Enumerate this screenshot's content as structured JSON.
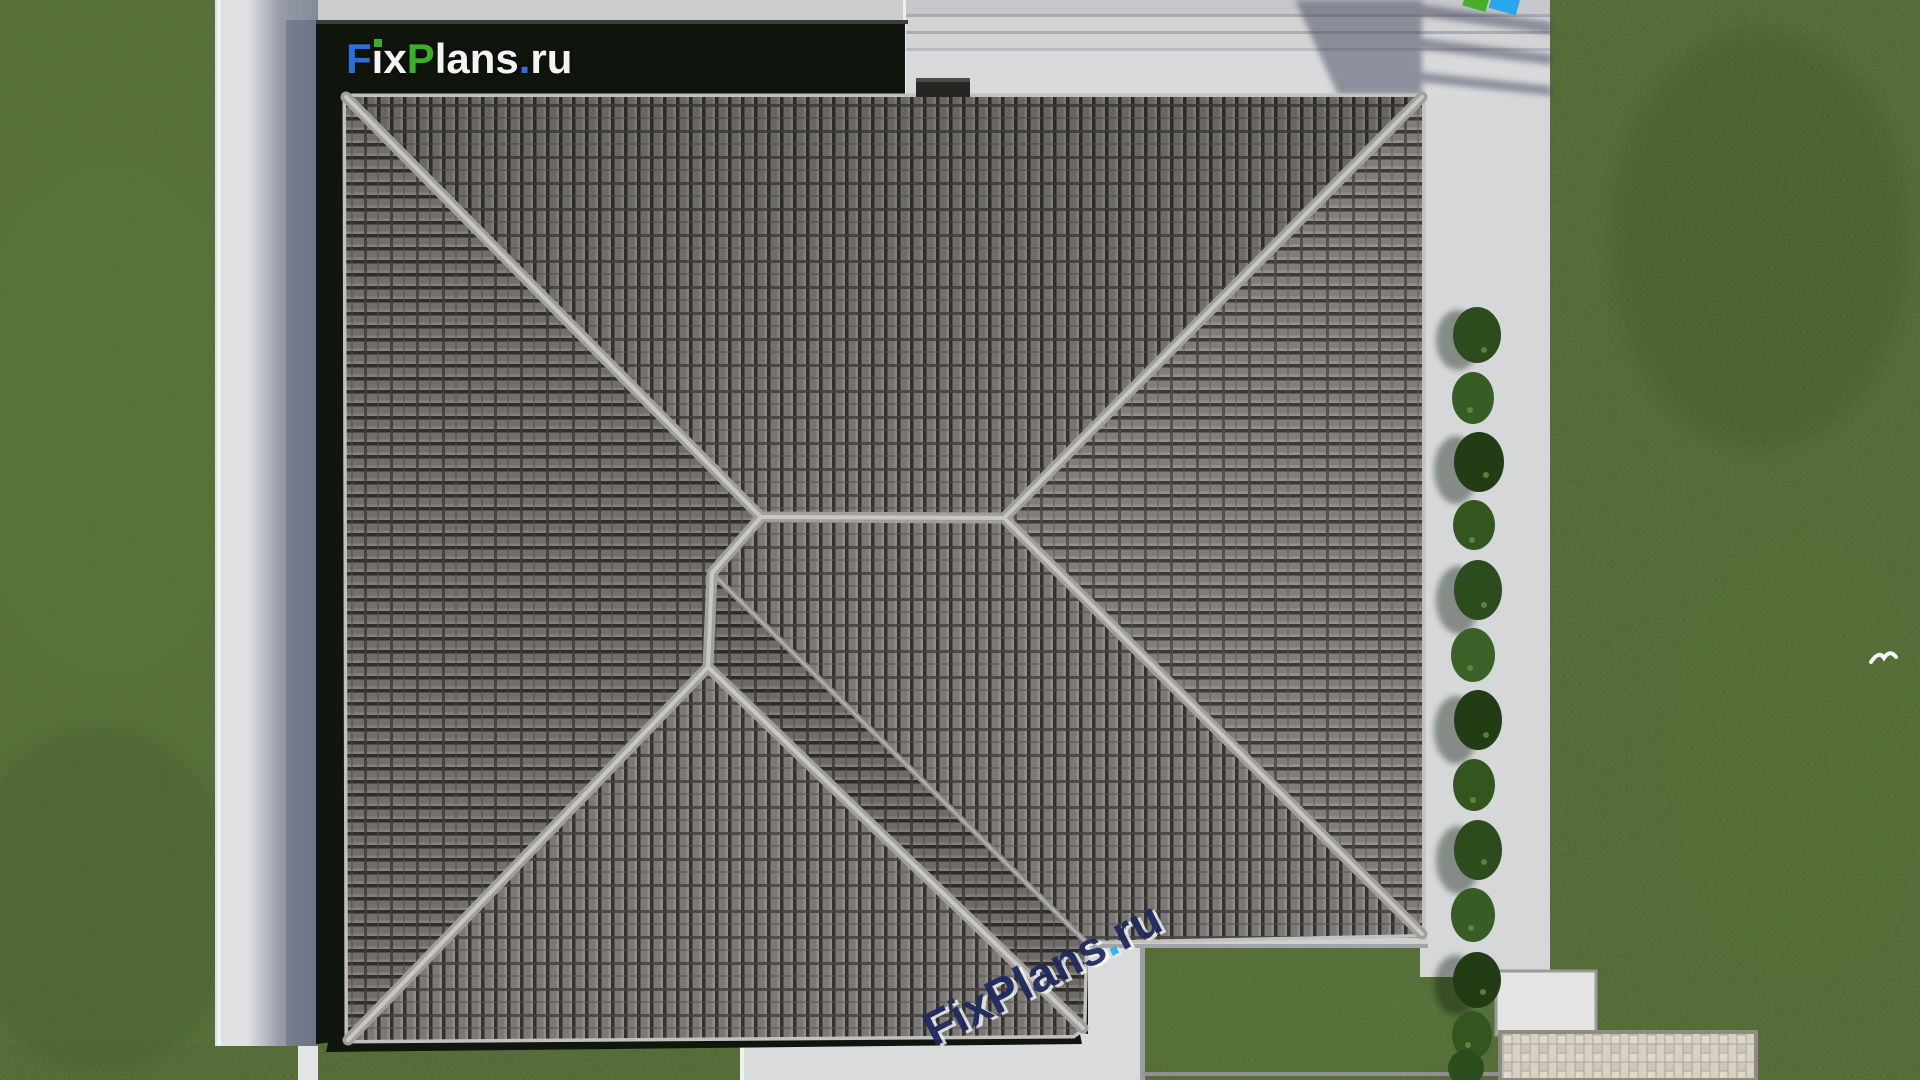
{
  "scene": {
    "type": "aerial-architectural-render",
    "subject": "Top-down view of a large hipped tile roof of a house, surrounded by concrete paving, lawn, a shrub hedge, entrance steps and a paver patio"
  },
  "branding": {
    "logo": {
      "full": "FixPlans.ru",
      "f": "F",
      "ix": "ix",
      "p": "P",
      "lans": "lans",
      "dot": ".",
      "ru": "ru",
      "colors": {
        "blue": "#2c6fd6",
        "green": "#3cae2b",
        "white": "#f4f4f4",
        "background": "#0e130c"
      }
    },
    "watermark_bottom": {
      "text": "FixPlans.ru",
      "main": "FixPlans",
      "dot": ".",
      "ru": "ru",
      "colors": {
        "navy": "#1e2a5e",
        "cyan": "#28b4ec"
      }
    },
    "watermark_top_partial": {
      "colors": {
        "green": "#46b02c",
        "blue": "#2aa7ec"
      }
    }
  },
  "palette": {
    "grass": "#4f6a2e",
    "grass_dark": "#40572a",
    "pavement": "#d8d9db",
    "pavement_shadow": "#8f96a6",
    "steps": "#cdcfd2",
    "roof_tile": "#7b7875",
    "roof_tile_gap": "#343230",
    "ridge_cap": "#b4b2af",
    "dark_band": "#10150d",
    "fascia": "#c3c1be",
    "bush_green": "#30511f",
    "herringbone_paver": "#d6d1c3",
    "concrete_pad": "#e4e4e3"
  }
}
